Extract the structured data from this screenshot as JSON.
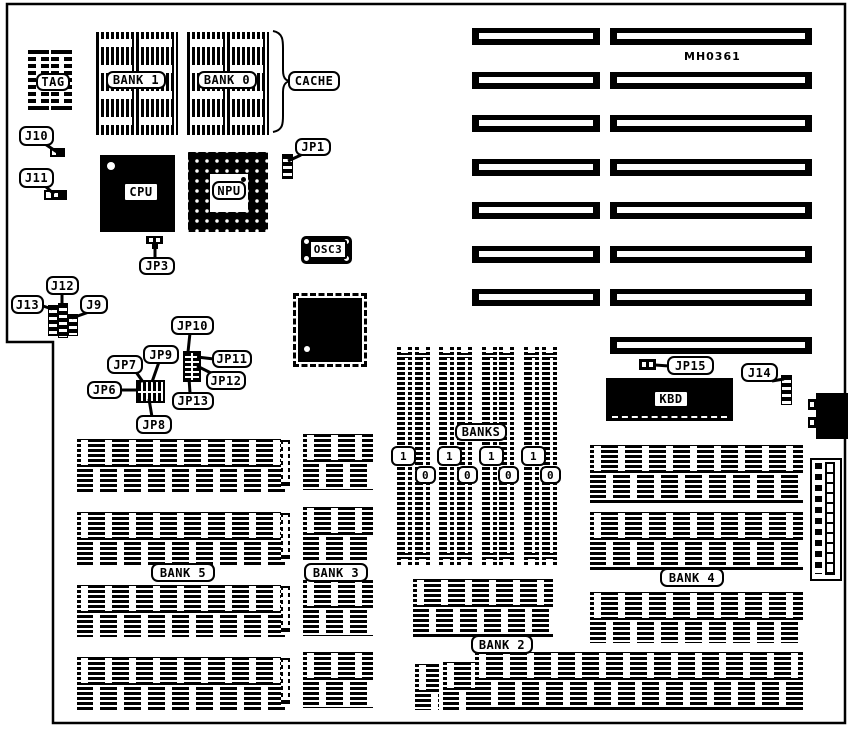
{
  "diagram": {
    "part_number": "MH0361",
    "labels": {
      "tag": "TAG",
      "bank1": "BANK 1",
      "bank0": "BANK 0",
      "cache": "CACHE",
      "cpu": "CPU",
      "npu": "NPU",
      "osc": "OSC3",
      "j9": "J9",
      "j10": "J10",
      "j11": "J11",
      "j12": "J12",
      "j13": "J13",
      "j14": "J14",
      "jp1": "JP1",
      "jp3": "JP3",
      "jp6": "JP6",
      "jp7": "JP7",
      "jp8": "JP8",
      "jp9": "JP9",
      "jp10": "JP10",
      "jp11": "JP11",
      "jp12": "JP12",
      "jp13": "JP13",
      "jp15": "JP15",
      "kbd": "KBD",
      "banks": "BANKS",
      "simm_bank1": "1",
      "simm_bank0": "0",
      "bank2": "BANK 2",
      "bank3": "BANK 3",
      "bank4": "BANK 4",
      "bank5": "BANK 5"
    },
    "colors": {
      "ink": "#000000",
      "paper": "#ffffff"
    }
  }
}
